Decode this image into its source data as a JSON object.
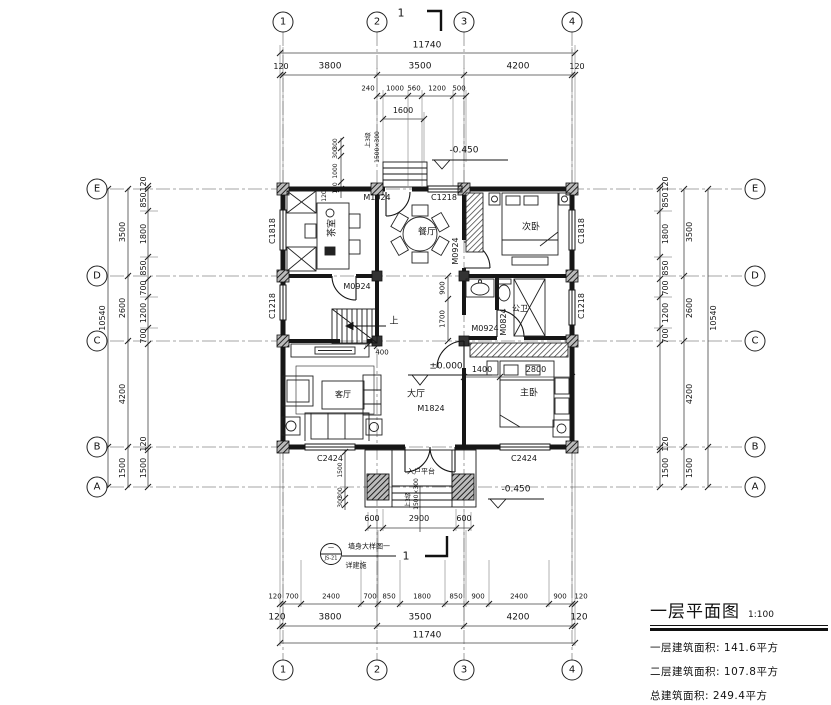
{
  "drawing": {
    "title_block": {
      "title": "一层平面图",
      "scale": "1:100",
      "areas": [
        {
          "label": "一层建筑面积:",
          "value": "141.6平方"
        },
        {
          "label": "二层建筑面积:",
          "value": "107.8平方"
        },
        {
          "label": "总建筑面积:",
          "value": "249.4平方"
        }
      ]
    },
    "grid": {
      "cols": [
        {
          "label": "1",
          "x": 283
        },
        {
          "label": "2",
          "x": 377
        },
        {
          "label": "3",
          "x": 464
        },
        {
          "label": "4",
          "x": 572
        }
      ],
      "rows": [
        {
          "label": "E",
          "y": 189
        },
        {
          "label": "D",
          "y": 276
        },
        {
          "label": "C",
          "y": 341
        },
        {
          "label": "B",
          "y": 447
        },
        {
          "label": "A",
          "y": 487
        }
      ],
      "left_x": 97,
      "right_x": 755,
      "top_y": 22,
      "bottom_y": 670
    },
    "line_color": "#161616"
  },
  "label_groups": {
    "rooms": [
      {
        "id": "room-tea-label",
        "t": "茶室",
        "x": 333,
        "y": 228,
        "s": 9,
        "r": -90
      },
      {
        "id": "room-dining-label",
        "t": "餐厅",
        "x": 427,
        "y": 233,
        "s": 9
      },
      {
        "id": "room-bed2-label",
        "t": "次卧",
        "x": 531,
        "y": 228,
        "s": 9
      },
      {
        "id": "room-bath-label",
        "t": "公卫",
        "x": 520,
        "y": 309,
        "s": 8
      },
      {
        "id": "room-bed1-label",
        "t": "主卧",
        "x": 529,
        "y": 394,
        "s": 9
      },
      {
        "id": "room-living-label",
        "t": "客厅",
        "x": 343,
        "y": 395,
        "s": 8
      },
      {
        "id": "room-hall-label",
        "t": "大厅",
        "x": 416,
        "y": 395,
        "s": 9
      },
      {
        "id": "room-entry-platform-label",
        "t": "入户平台",
        "x": 421,
        "y": 472,
        "s": 7
      }
    ],
    "openings": [
      {
        "id": "door-M1024-label",
        "t": "M1024",
        "x": 377,
        "y": 198,
        "s": 8
      },
      {
        "id": "window-C1218-top-label",
        "t": "C1218",
        "x": 444,
        "y": 198,
        "s": 8
      },
      {
        "id": "door-M0924-tea-label",
        "t": "M0924",
        "x": 357,
        "y": 287,
        "s": 8
      },
      {
        "id": "door-M0924-bed2-label",
        "t": "M0924",
        "x": 456,
        "y": 251,
        "s": 8,
        "r": -90
      },
      {
        "id": "door-M0924-hall-label",
        "t": "M0924",
        "x": 485,
        "y": 329,
        "s": 8
      },
      {
        "id": "door-M0824-label",
        "t": "M0824",
        "x": 504,
        "y": 322,
        "s": 8,
        "r": -90
      },
      {
        "id": "door-M1824-label",
        "t": "M1824",
        "x": 431,
        "y": 409,
        "s": 8
      },
      {
        "id": "window-C1818-left-label",
        "t": "C1818",
        "x": 273,
        "y": 231,
        "s": 8,
        "r": -90
      },
      {
        "id": "window-C1218-left-label",
        "t": "C1218",
        "x": 273,
        "y": 306,
        "s": 8,
        "r": -90
      },
      {
        "id": "window-C1818-right-label",
        "t": "C1818",
        "x": 582,
        "y": 231,
        "s": 8,
        "r": -90
      },
      {
        "id": "window-C1218-right-label",
        "t": "C1218",
        "x": 582,
        "y": 306,
        "s": 8,
        "r": -90
      },
      {
        "id": "window-C2424-bl-label",
        "t": "C2424",
        "x": 330,
        "y": 459,
        "s": 8
      },
      {
        "id": "window-C2424-br-label",
        "t": "C2424",
        "x": 524,
        "y": 459,
        "s": 8
      }
    ],
    "levels": [
      {
        "id": "level-zero",
        "t": "±0.000",
        "x": 446,
        "y": 367,
        "s": 9
      },
      {
        "id": "level-top",
        "t": "-0.450",
        "x": 464,
        "y": 151,
        "s": 9
      },
      {
        "id": "level-bottom",
        "t": "-0.450",
        "x": 516,
        "y": 490,
        "s": 9
      }
    ],
    "stair": [
      {
        "id": "stair-up-label",
        "t": "上",
        "x": 394,
        "y": 322,
        "s": 9
      },
      {
        "id": "stair-steps-top",
        "t": "上3级",
        "x": 369,
        "y": 140,
        "s": 6,
        "r": -90
      },
      {
        "id": "stair-size-top",
        "t": "1500×300",
        "x": 378,
        "y": 147,
        "s": 6,
        "r": -90
      },
      {
        "id": "stair-steps-bottom",
        "t": "上3级",
        "x": 409,
        "y": 500,
        "s": 6,
        "r": -90
      },
      {
        "id": "stair-size-bottom",
        "t": "1500×300",
        "x": 417,
        "y": 494,
        "s": 6,
        "r": -90
      }
    ],
    "dims_top": [
      {
        "id": "dim",
        "t": "11740",
        "x": 427,
        "y": 46,
        "s": 9
      },
      {
        "id": "dim",
        "t": "120",
        "x": 281,
        "y": 67,
        "s": 8
      },
      {
        "id": "dim",
        "t": "3800",
        "x": 330,
        "y": 67,
        "s": 9
      },
      {
        "id": "dim",
        "t": "3500",
        "x": 420,
        "y": 67,
        "s": 9
      },
      {
        "id": "dim",
        "t": "4200",
        "x": 518,
        "y": 67,
        "s": 9
      },
      {
        "id": "dim",
        "t": "120",
        "x": 577,
        "y": 67,
        "s": 8
      },
      {
        "id": "dim",
        "t": "240",
        "x": 368,
        "y": 89,
        "s": 7
      },
      {
        "id": "dim",
        "t": "1000",
        "x": 395,
        "y": 89,
        "s": 7
      },
      {
        "id": "dim",
        "t": "560",
        "x": 414,
        "y": 89,
        "s": 7
      },
      {
        "id": "dim",
        "t": "1200",
        "x": 437,
        "y": 89,
        "s": 7
      },
      {
        "id": "dim",
        "t": "500",
        "x": 459,
        "y": 89,
        "s": 7
      },
      {
        "id": "dim",
        "t": "1600",
        "x": 403,
        "y": 111,
        "s": 8
      }
    ],
    "dims_bottom": [
      {
        "id": "dim",
        "t": "600",
        "x": 372,
        "y": 519,
        "s": 8
      },
      {
        "id": "dim",
        "t": "2900",
        "x": 419,
        "y": 519,
        "s": 8
      },
      {
        "id": "dim",
        "t": "600",
        "x": 464,
        "y": 519,
        "s": 8
      },
      {
        "id": "dim",
        "t": "120",
        "x": 275,
        "y": 597,
        "s": 7
      },
      {
        "id": "dim",
        "t": "700",
        "x": 292,
        "y": 597,
        "s": 7
      },
      {
        "id": "dim",
        "t": "2400",
        "x": 331,
        "y": 597,
        "s": 7
      },
      {
        "id": "dim",
        "t": "700",
        "x": 370,
        "y": 597,
        "s": 7
      },
      {
        "id": "dim",
        "t": "850",
        "x": 389,
        "y": 597,
        "s": 7
      },
      {
        "id": "dim",
        "t": "1800",
        "x": 422,
        "y": 597,
        "s": 7
      },
      {
        "id": "dim",
        "t": "850",
        "x": 456,
        "y": 597,
        "s": 7
      },
      {
        "id": "dim",
        "t": "900",
        "x": 478,
        "y": 597,
        "s": 7
      },
      {
        "id": "dim",
        "t": "2400",
        "x": 519,
        "y": 597,
        "s": 7
      },
      {
        "id": "dim",
        "t": "900",
        "x": 560,
        "y": 597,
        "s": 7
      },
      {
        "id": "dim",
        "t": "120",
        "x": 581,
        "y": 597,
        "s": 7
      },
      {
        "id": "dim",
        "t": "120",
        "x": 277,
        "y": 618,
        "s": 9
      },
      {
        "id": "dim",
        "t": "3800",
        "x": 330,
        "y": 618,
        "s": 9
      },
      {
        "id": "dim",
        "t": "3500",
        "x": 420,
        "y": 618,
        "s": 9
      },
      {
        "id": "dim",
        "t": "4200",
        "x": 518,
        "y": 618,
        "s": 9
      },
      {
        "id": "dim",
        "t": "120",
        "x": 579,
        "y": 618,
        "s": 9
      },
      {
        "id": "dim",
        "t": "11740",
        "x": 427,
        "y": 636,
        "s": 9
      }
    ],
    "dims_left": [
      {
        "id": "dim",
        "t": "120",
        "x": 144,
        "y": 184,
        "s": 8,
        "r": -90
      },
      {
        "id": "dim",
        "t": "850",
        "x": 144,
        "y": 200,
        "s": 8,
        "r": -90
      },
      {
        "id": "dim",
        "t": "1800",
        "x": 144,
        "y": 234,
        "s": 8,
        "r": -90
      },
      {
        "id": "dim",
        "t": "850",
        "x": 144,
        "y": 268,
        "s": 8,
        "r": -90
      },
      {
        "id": "dim",
        "t": "700",
        "x": 144,
        "y": 288,
        "s": 8,
        "r": -90
      },
      {
        "id": "dim",
        "t": "1200",
        "x": 144,
        "y": 313,
        "s": 8,
        "r": -90
      },
      {
        "id": "dim",
        "t": "700",
        "x": 144,
        "y": 336,
        "s": 8,
        "r": -90
      },
      {
        "id": "dim",
        "t": "120",
        "x": 144,
        "y": 444,
        "s": 8,
        "r": -90
      },
      {
        "id": "dim",
        "t": "1500",
        "x": 144,
        "y": 468,
        "s": 8,
        "r": -90
      },
      {
        "id": "dim",
        "t": "3500",
        "x": 123,
        "y": 232,
        "s": 8,
        "r": -90
      },
      {
        "id": "dim",
        "t": "2600",
        "x": 123,
        "y": 308,
        "s": 8,
        "r": -90
      },
      {
        "id": "dim",
        "t": "4200",
        "x": 123,
        "y": 394,
        "s": 8,
        "r": -90
      },
      {
        "id": "dim",
        "t": "1500",
        "x": 123,
        "y": 468,
        "s": 8,
        "r": -90
      },
      {
        "id": "dim",
        "t": "10540",
        "x": 103,
        "y": 318,
        "s": 8,
        "r": -90
      }
    ],
    "dims_right": [
      {
        "id": "dim",
        "t": "120",
        "x": 666,
        "y": 184,
        "s": 8,
        "r": -90
      },
      {
        "id": "dim",
        "t": "850",
        "x": 666,
        "y": 200,
        "s": 8,
        "r": -90
      },
      {
        "id": "dim",
        "t": "1800",
        "x": 666,
        "y": 234,
        "s": 8,
        "r": -90
      },
      {
        "id": "dim",
        "t": "850",
        "x": 666,
        "y": 268,
        "s": 8,
        "r": -90
      },
      {
        "id": "dim",
        "t": "700",
        "x": 666,
        "y": 288,
        "s": 8,
        "r": -90
      },
      {
        "id": "dim",
        "t": "1200",
        "x": 666,
        "y": 313,
        "s": 8,
        "r": -90
      },
      {
        "id": "dim",
        "t": "700",
        "x": 666,
        "y": 336,
        "s": 8,
        "r": -90
      },
      {
        "id": "dim",
        "t": "120",
        "x": 666,
        "y": 444,
        "s": 8,
        "r": -90
      },
      {
        "id": "dim",
        "t": "1500",
        "x": 666,
        "y": 468,
        "s": 8,
        "r": -90
      },
      {
        "id": "dim",
        "t": "3500",
        "x": 690,
        "y": 232,
        "s": 8,
        "r": -90
      },
      {
        "id": "dim",
        "t": "2600",
        "x": 690,
        "y": 308,
        "s": 8,
        "r": -90
      },
      {
        "id": "dim",
        "t": "4200",
        "x": 690,
        "y": 394,
        "s": 8,
        "r": -90
      },
      {
        "id": "dim",
        "t": "1500",
        "x": 690,
        "y": 468,
        "s": 8,
        "r": -90
      },
      {
        "id": "dim",
        "t": "10540",
        "x": 714,
        "y": 318,
        "s": 8,
        "r": -90
      }
    ],
    "dims_interior": [
      {
        "id": "dim",
        "t": "900",
        "x": 443,
        "y": 288,
        "s": 7,
        "r": -90
      },
      {
        "id": "dim",
        "t": "1700",
        "x": 443,
        "y": 319,
        "s": 7,
        "r": -90
      },
      {
        "id": "dim",
        "t": "400",
        "x": 382,
        "y": 353,
        "s": 7
      },
      {
        "id": "dim",
        "t": "1400",
        "x": 482,
        "y": 370,
        "s": 8
      },
      {
        "id": "dim",
        "t": "2800",
        "x": 536,
        "y": 370,
        "s": 8
      },
      {
        "id": "dim",
        "t": "120",
        "x": 325,
        "y": 196,
        "s": 6,
        "r": -90
      },
      {
        "id": "dim",
        "t": "300",
        "x": 336,
        "y": 144,
        "s": 6,
        "r": -90
      },
      {
        "id": "dim",
        "t": "300",
        "x": 336,
        "y": 153,
        "s": 6,
        "r": -90
      },
      {
        "id": "dim",
        "t": "1000",
        "x": 336,
        "y": 171,
        "s": 6,
        "r": -90
      },
      {
        "id": "dim",
        "t": "120",
        "x": 336,
        "y": 188,
        "s": 6,
        "r": -90
      },
      {
        "id": "dim",
        "t": "1500",
        "x": 341,
        "y": 470,
        "s": 6,
        "r": -90
      },
      {
        "id": "dim",
        "t": "300",
        "x": 341,
        "y": 493,
        "s": 6,
        "r": -90
      },
      {
        "id": "dim",
        "t": "300",
        "x": 341,
        "y": 502,
        "s": 6,
        "r": -90
      }
    ],
    "annotations": [
      {
        "id": "section-mark-1-top",
        "t": "1",
        "x": 401,
        "y": 13,
        "s": 11
      },
      {
        "id": "section-mark-1-bottom",
        "t": "1",
        "x": 406,
        "y": 556,
        "s": 11
      },
      {
        "id": "detail-callout-top",
        "t": "一",
        "x": 331,
        "y": 549,
        "s": 6
      },
      {
        "id": "detail-callout-code",
        "t": "JS-21",
        "x": 331,
        "y": 559,
        "s": 5
      },
      {
        "id": "detail-callout-text",
        "t": "墙身大样图一",
        "x": 369,
        "y": 547,
        "s": 7
      },
      {
        "id": "detail-callout-note",
        "t": "详建施",
        "x": 356,
        "y": 566,
        "s": 7
      }
    ]
  }
}
